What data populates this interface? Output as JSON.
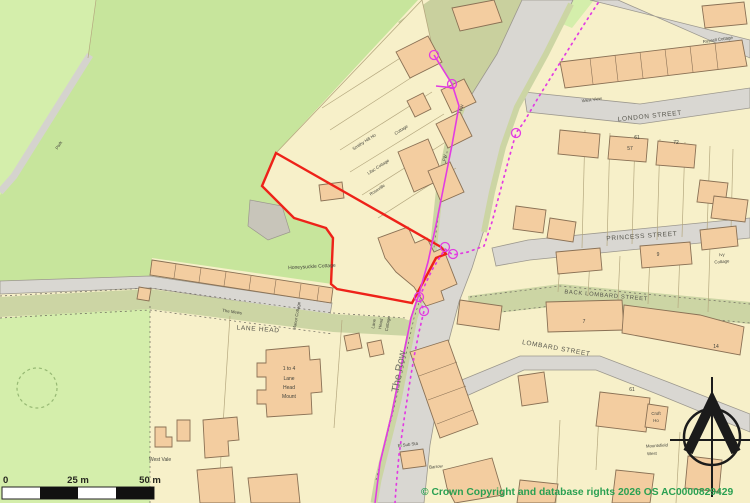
{
  "labels": {
    "park": "Park",
    "cottage": "Cottage",
    "smithy_hill_ho": "Smithy Hill Ho",
    "lilac_cottage": "Lilac Cottage",
    "roseville": "Roseville",
    "honeysuckle_cottage": "Honeysuckle Cottage",
    "the_mews": "The Mews",
    "manor_cottage": "Manor Cottage",
    "lane_head": "LANE HEAD",
    "lane_head_cottage_l1": "Lane",
    "lane_head_cottage_l2": "Head",
    "lane_head_cottage_l3": "Cottage",
    "lane_head_mount_l1": "1 to 4",
    "lane_head_mount_l2": "Lane",
    "lane_head_mount_l3": "Head",
    "lane_head_mount_l4": "Mount",
    "west_vale": "West Vale",
    "the_row": "The Row",
    "el_sub_sta": "El Sub Sta",
    "barrow": "Barrow",
    "fw1": "FW",
    "fw2": "FW",
    "london_street": "LONDON STREET",
    "west_view": "West View",
    "russell_cottage": "Russell Cottage",
    "princess_street": "PRINCESS STREET",
    "ivy_cottage_l1": "Ivy",
    "ivy_cottage_l2": "Cottage",
    "back_lombard_street": "BACK LOMBARD STREET",
    "lombard_street": "LOMBARD STREET",
    "croft_ho_l1": "Croft",
    "croft_ho_l2": "Ho",
    "mountsfield_l1": "Mountsfield",
    "mountsfield_l2": "West"
  },
  "numbers": {
    "n61": "61",
    "n57": "57",
    "n72": "72",
    "n9": "9",
    "n7": "7",
    "n14": "14",
    "n61b": "61"
  },
  "scale_bar": {
    "start": "0",
    "mid": "25 m",
    "end": "50 m"
  },
  "copyright": "© Crown Copyright and database rights 2026 OS AC0000829429",
  "colors": {
    "cream": "#f7f0c9",
    "parcel_line": "#b5a87f",
    "building": "#f3cda0",
    "building_edge": "#8a7155",
    "green_light": "#d4eeab",
    "green_mid": "#c7e59c",
    "green_olive": "#c9d09e",
    "track": "#ccd5a4",
    "road": "#d9d7d2",
    "road_edge": "#9c988e",
    "gray_patch": "#c8c5ba",
    "red": "#ee2219",
    "magenta": "#e23ce2",
    "label": "#44443c",
    "street_label": "#56554c",
    "copyright": "#2aa052",
    "black": "#1b1b1b"
  }
}
